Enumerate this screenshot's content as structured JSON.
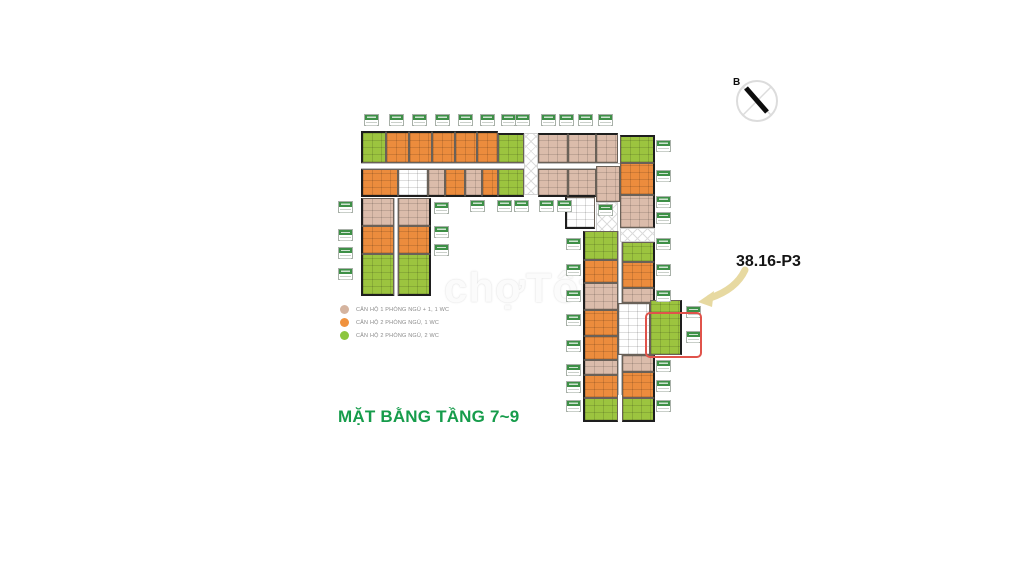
{
  "title": {
    "text": "MẶT BẰNG TẦNG 7~9",
    "color": "#169C4B"
  },
  "annotation": {
    "text": "38.16-P3"
  },
  "compass": {
    "label": "B"
  },
  "watermark": {
    "text": "chợTốt"
  },
  "legend": {
    "items": [
      {
        "color": "#D5B49F",
        "label": "CĂN HỘ 1 PHÒNG NGỦ + 1, 1 WC"
      },
      {
        "color": "#F0923E",
        "label": "CĂN HỘ 2 PHÒNG NGỦ, 1 WC"
      },
      {
        "color": "#8DC63F",
        "label": "CĂN HỘ 2 PHÒNG NGỦ, 2 WC"
      }
    ]
  },
  "colors": {
    "unit_orange": "#EC8C3D",
    "unit_tan": "#DBBCAB",
    "unit_green": "#9CC43F",
    "label_chip_green": "#3E9047",
    "highlight_red": "#E0534B",
    "arrow_tan": "#E7D9A1",
    "title_green": "#169C4B"
  },
  "floor_plan": {
    "units": [
      [
        361,
        131,
        25,
        32,
        "g",
        "tl"
      ],
      [
        386,
        131,
        23,
        32,
        "o",
        "t"
      ],
      [
        409,
        131,
        23,
        32,
        "o",
        "t"
      ],
      [
        432,
        131,
        23,
        32,
        "o",
        "t"
      ],
      [
        455,
        131,
        22,
        32,
        "o",
        "t"
      ],
      [
        477,
        131,
        21,
        32,
        "o",
        "t"
      ],
      [
        498,
        133,
        26,
        30,
        "g",
        "t"
      ],
      [
        524,
        133,
        14,
        62,
        "x",
        ""
      ],
      [
        538,
        133,
        30,
        30,
        "t",
        "t"
      ],
      [
        568,
        133,
        28,
        30,
        "t",
        "t"
      ],
      [
        596,
        133,
        22,
        30,
        "t",
        "t"
      ],
      [
        620,
        135,
        35,
        28,
        "g",
        "tr"
      ],
      [
        361,
        169,
        37,
        28,
        "o",
        "bl"
      ],
      [
        398,
        169,
        30,
        28,
        "w",
        "b"
      ],
      [
        428,
        169,
        17,
        28,
        "t",
        "b"
      ],
      [
        445,
        169,
        20,
        28,
        "o",
        "b"
      ],
      [
        465,
        169,
        17,
        28,
        "t",
        "b"
      ],
      [
        482,
        169,
        16,
        28,
        "o",
        "b"
      ],
      [
        498,
        169,
        26,
        28,
        "g",
        "b"
      ],
      [
        538,
        169,
        30,
        28,
        "t",
        "b"
      ],
      [
        568,
        169,
        28,
        28,
        "t",
        "b"
      ],
      [
        596,
        166,
        24,
        36,
        "t",
        ""
      ],
      [
        620,
        163,
        35,
        32,
        "o",
        "r"
      ],
      [
        620,
        195,
        35,
        33,
        "t",
        "r"
      ],
      [
        565,
        197,
        30,
        32,
        "w",
        "bl"
      ],
      [
        596,
        202,
        22,
        42,
        "x",
        ""
      ],
      [
        620,
        228,
        35,
        14,
        "x",
        ""
      ],
      [
        361,
        198,
        33,
        28,
        "t",
        "l"
      ],
      [
        398,
        198,
        33,
        28,
        "t",
        "r"
      ],
      [
        361,
        226,
        33,
        28,
        "o",
        "l"
      ],
      [
        398,
        226,
        33,
        28,
        "o",
        "r"
      ],
      [
        361,
        254,
        33,
        42,
        "g",
        "bl"
      ],
      [
        398,
        254,
        33,
        42,
        "g",
        "br"
      ],
      [
        583,
        231,
        35,
        29,
        "g",
        "l"
      ],
      [
        583,
        260,
        35,
        23,
        "o",
        "l"
      ],
      [
        583,
        283,
        35,
        27,
        "t",
        "l"
      ],
      [
        583,
        310,
        35,
        26,
        "o",
        "l"
      ],
      [
        583,
        336,
        35,
        24,
        "o",
        "l"
      ],
      [
        583,
        360,
        35,
        15,
        "t",
        "l"
      ],
      [
        583,
        375,
        35,
        23,
        "o",
        "l"
      ],
      [
        583,
        398,
        35,
        24,
        "g",
        "bl"
      ],
      [
        622,
        242,
        33,
        20,
        "g",
        "r"
      ],
      [
        622,
        262,
        33,
        26,
        "o",
        "r"
      ],
      [
        622,
        288,
        33,
        15,
        "t",
        "r"
      ],
      [
        618,
        303,
        32,
        52,
        "w",
        ""
      ],
      [
        650,
        300,
        32,
        55,
        "g",
        "r"
      ],
      [
        622,
        355,
        33,
        17,
        "t",
        "r"
      ],
      [
        622,
        372,
        33,
        26,
        "o",
        "r"
      ],
      [
        622,
        398,
        33,
        24,
        "g",
        "br"
      ]
    ],
    "corridors": [
      [
        361,
        163,
        294,
        6,
        "h"
      ],
      [
        394,
        198,
        4,
        98,
        "v"
      ],
      [
        618,
        231,
        4,
        164,
        "v"
      ]
    ],
    "chips": [
      [
        364,
        114
      ],
      [
        389,
        114
      ],
      [
        412,
        114
      ],
      [
        435,
        114
      ],
      [
        458,
        114
      ],
      [
        480,
        114
      ],
      [
        501,
        114
      ],
      [
        515,
        114
      ],
      [
        541,
        114
      ],
      [
        559,
        114
      ],
      [
        578,
        114
      ],
      [
        598,
        114
      ],
      [
        470,
        200
      ],
      [
        497,
        200
      ],
      [
        514,
        200
      ],
      [
        539,
        200
      ],
      [
        557,
        200
      ],
      [
        598,
        204
      ],
      [
        338,
        201
      ],
      [
        338,
        229
      ],
      [
        338,
        247
      ],
      [
        338,
        268
      ],
      [
        434,
        202
      ],
      [
        434,
        226
      ],
      [
        434,
        244
      ],
      [
        566,
        238
      ],
      [
        566,
        264
      ],
      [
        566,
        290
      ],
      [
        566,
        314
      ],
      [
        566,
        340
      ],
      [
        566,
        364
      ],
      [
        566,
        381
      ],
      [
        566,
        400
      ],
      [
        656,
        140
      ],
      [
        656,
        170
      ],
      [
        656,
        196
      ],
      [
        656,
        212
      ],
      [
        656,
        238
      ],
      [
        656,
        264
      ],
      [
        656,
        290
      ],
      [
        656,
        360
      ],
      [
        656,
        380
      ],
      [
        656,
        400
      ],
      [
        686,
        306
      ],
      [
        686,
        331
      ]
    ],
    "highlight": {
      "x": 645,
      "y": 312,
      "w": 57,
      "h": 46
    }
  }
}
